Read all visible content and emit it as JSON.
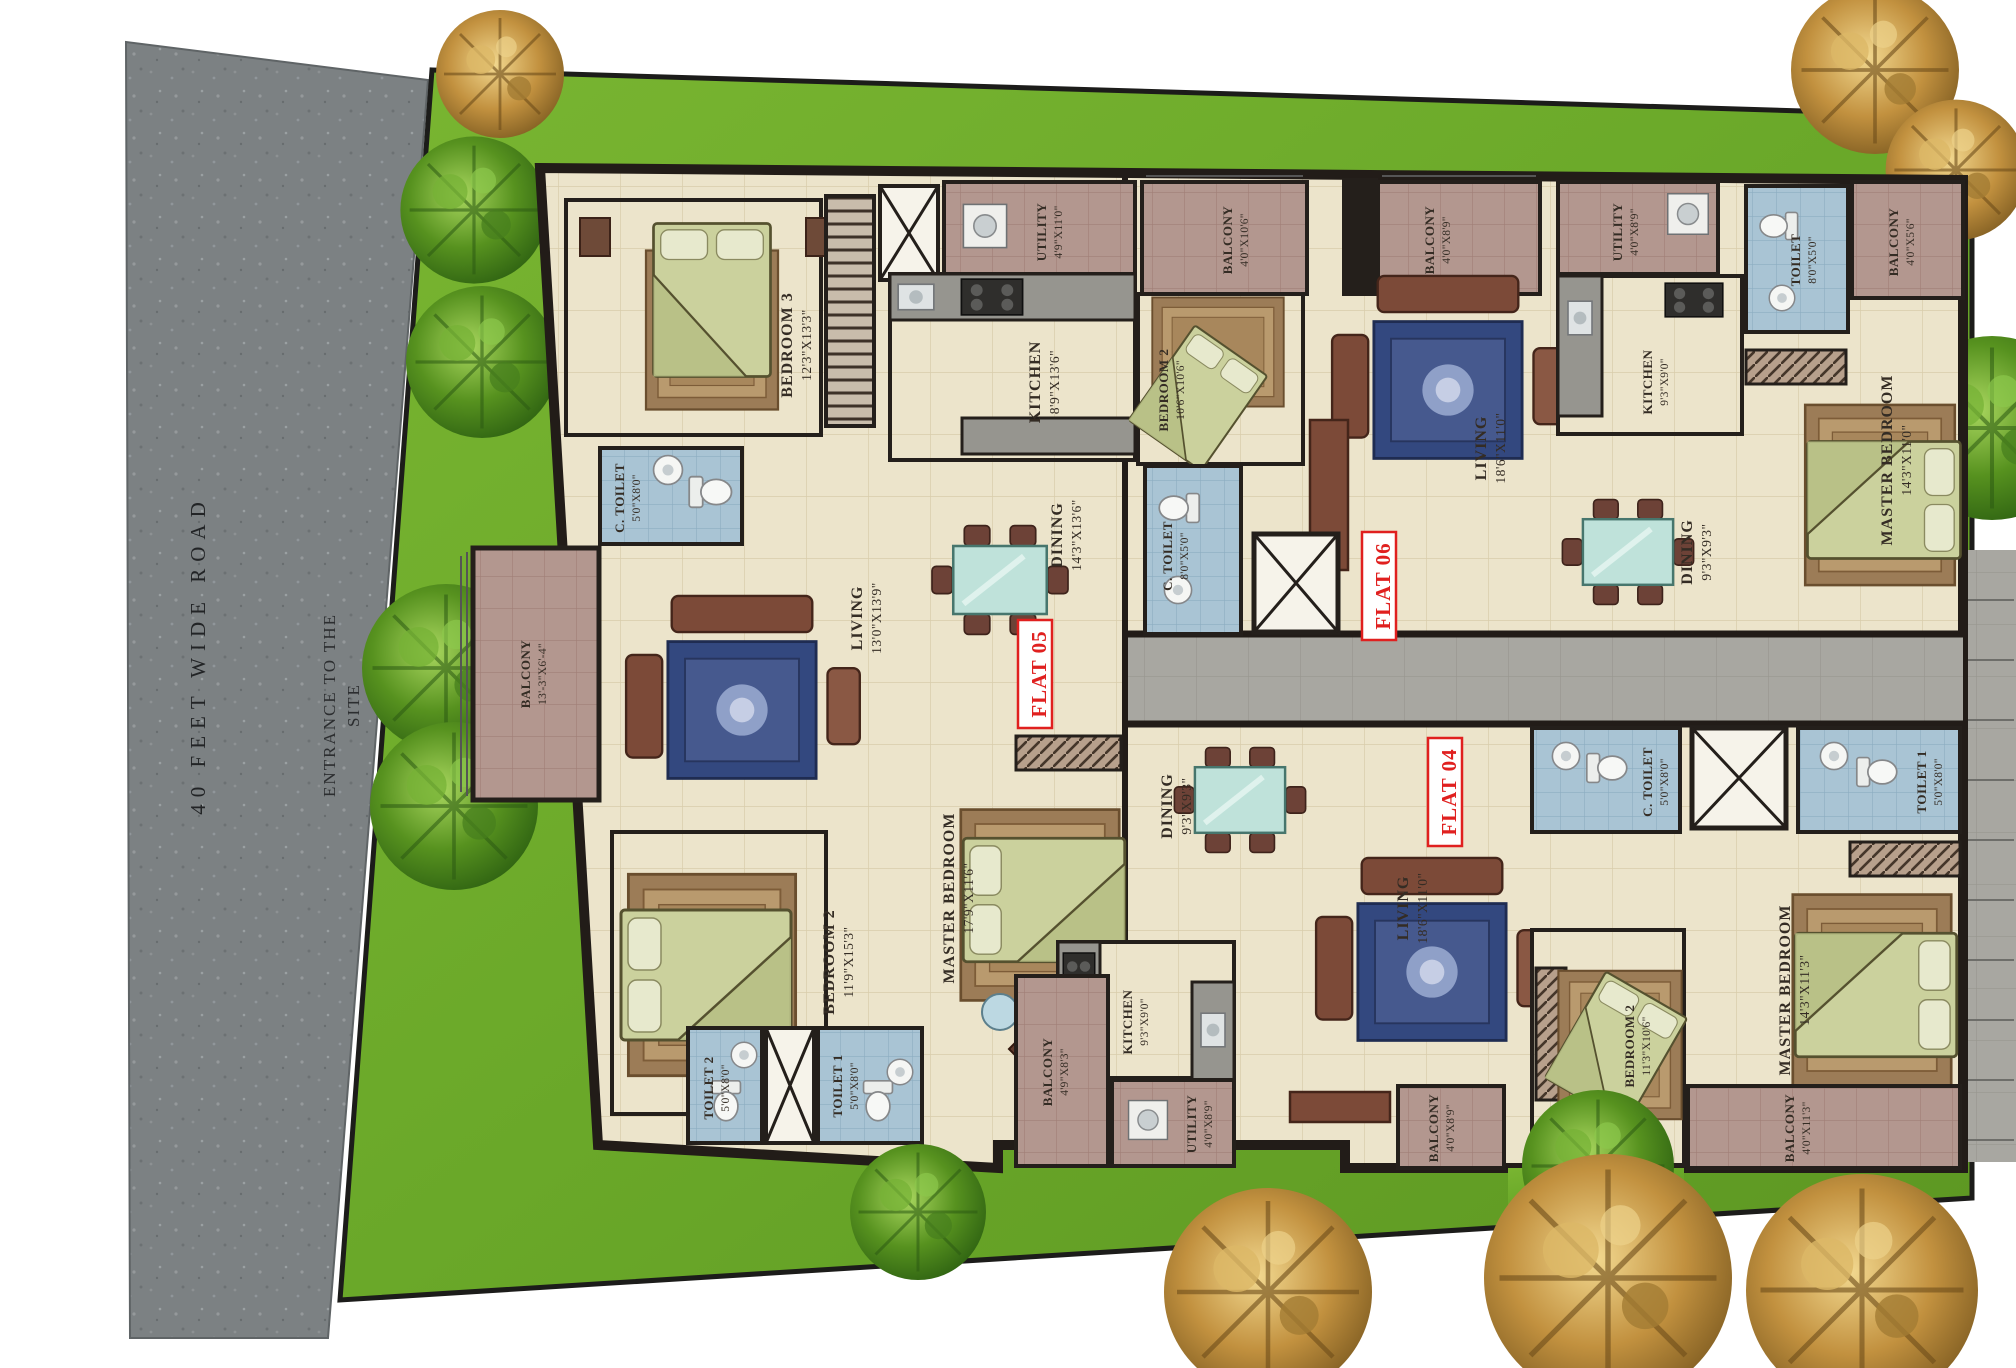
{
  "site": {
    "road_label": "40 FEET WIDE ROAD",
    "entrance_label_line1": "ENTRANCE TO THE",
    "entrance_label_line2": "SITE"
  },
  "flat05": {
    "label": "FLAT 05",
    "bedroom3": {
      "name": "BEDROOM 3",
      "dims": "12'3\"X13'3\""
    },
    "ctoilet": {
      "name": "C. TOILET",
      "dims": "5'0\"X8'0\""
    },
    "utility": {
      "name": "UTILITY",
      "dims": "4'9\"X11'0\""
    },
    "kitchen": {
      "name": "KITCHEN",
      "dims": "8'9\"X13'6\""
    },
    "dining": {
      "name": "DINING",
      "dims": "14'3\"X13'6\""
    },
    "living": {
      "name": "LIVING",
      "dims": "13'0\"X13'9\""
    },
    "balcony": {
      "name": "BALCONY",
      "dims": "13'-3\"X6'-4\""
    },
    "bedroom2": {
      "name": "BEDROOM 2",
      "dims": "11'9\"X15'3\""
    },
    "master": {
      "name": "MASTER BEDROOM",
      "dims": "17'9\"X11'6\""
    },
    "toilet2": {
      "name": "TOILET 2",
      "dims": "5'0\"X8'0\""
    },
    "toilet1": {
      "name": "TOILET 1",
      "dims": "5'0\"X8'0\""
    }
  },
  "flat06": {
    "label": "FLAT 06",
    "balcony1": {
      "name": "BALCONY",
      "dims": "4'0\"X10'6\""
    },
    "bedroom2": {
      "name": "BEDROOM 2",
      "dims": "10'6\"X10'6\""
    },
    "balcony2": {
      "name": "BALCONY",
      "dims": "4'0\"X8'9\""
    },
    "living": {
      "name": "LIVING",
      "dims": "18'6\"X11'0\""
    },
    "ctoilet": {
      "name": "C. TOILET",
      "dims": "8'0\"X5'0\""
    },
    "dining": {
      "name": "DINING",
      "dims": "9'3\"X9'3\""
    },
    "utility": {
      "name": "UTILITY",
      "dims": "4'0\"X8'9\""
    },
    "kitchen": {
      "name": "KITCHEN",
      "dims": "9'3\"X9'0\""
    },
    "toilet": {
      "name": "TOILET",
      "dims": "8'0\"X5'0\""
    },
    "master": {
      "name": "MASTER BEDROOM",
      "dims": "14'3\"X11'0\""
    },
    "balcony3": {
      "name": "BALCONY",
      "dims": "4'0\"X5'6\""
    }
  },
  "flat04": {
    "label": "FLAT 04",
    "dining": {
      "name": "DINING",
      "dims": "9'3\"X9'3\""
    },
    "living": {
      "name": "LIVING",
      "dims": "18'6\"X11'0\""
    },
    "kitchen": {
      "name": "KITCHEN",
      "dims": "9'3\"X9'0\""
    },
    "utility": {
      "name": "UTILITY",
      "dims": "4'0\"X8'9\""
    },
    "balcony1": {
      "name": "BALCONY",
      "dims": "4'9\"X8'3\""
    },
    "ctoilet": {
      "name": "C. TOILET",
      "dims": "5'0\"X8'0\""
    },
    "toilet1": {
      "name": "TOILET 1",
      "dims": "5'0\"X8'0\""
    },
    "master": {
      "name": "MASTER BEDROOM",
      "dims": "14'3\"X11'3\""
    },
    "bedroom2": {
      "name": "BEDROOM 2",
      "dims": "11'3\"X10'6\""
    },
    "balcony2": {
      "name": "BALCONY",
      "dims": "4'0\"X8'9\""
    },
    "balcony3": {
      "name": "BALCONY",
      "dims": "4'0\"X11'3\""
    }
  }
}
